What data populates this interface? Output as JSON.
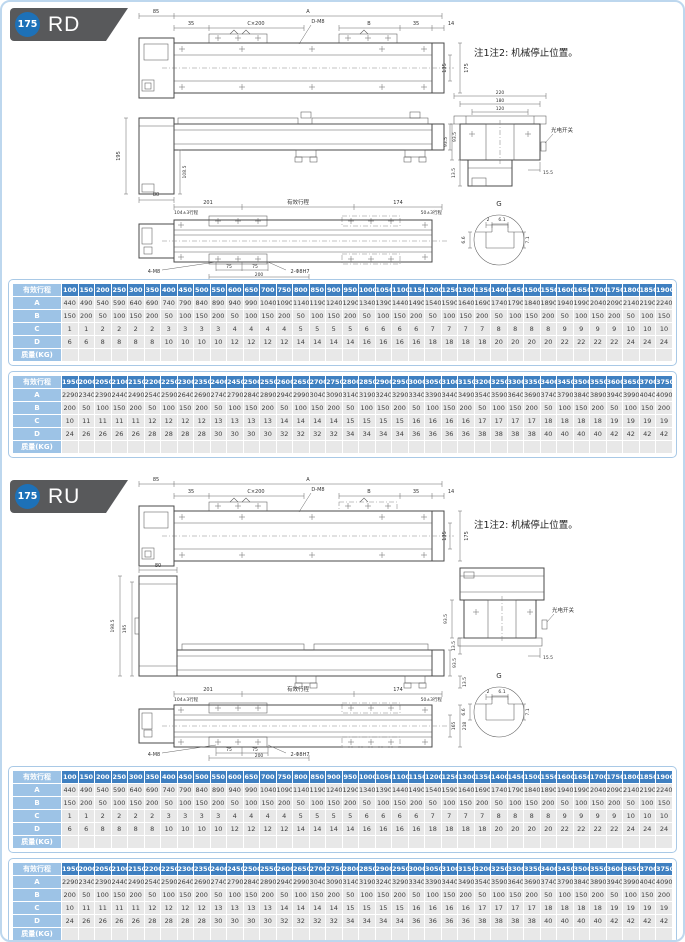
{
  "sections": [
    {
      "title": "RD",
      "badge": "175",
      "note": "注1注2: 机械停止位置。",
      "dims": {
        "a": "A",
        "b": "B",
        "d85": "85",
        "d35": "35",
        "c200": "C×200",
        "dm8": "D-M8",
        "d14": "14",
        "d135": "135",
        "d175": "175",
        "d195": "195",
        "d1085": "108.5",
        "d80": "80",
        "d935": "93.5",
        "d135s": "13.5",
        "d155": "15.5",
        "d201": "201",
        "stroke": "有效行程",
        "d174": "174",
        "d104": "104±3行程",
        "d50": "50±3行程",
        "d75": "75",
        "d200": "200",
        "m4": "4-M8",
        "m2": "2-Φ8H7",
        "d220": "220",
        "d180": "180",
        "d120": "120",
        "sw": "光电开关",
        "g": "G",
        "g2": "2",
        "g61": "6.1",
        "g71": "7.1",
        "g66": "6.6"
      }
    },
    {
      "title": "RU",
      "badge": "175",
      "note": "注1注2: 机械停止位置。",
      "dims": {
        "a": "A",
        "b": "B",
        "d85": "85",
        "d35": "35",
        "c200": "C×200",
        "dm8": "D-M8",
        "d14": "14",
        "d135": "135",
        "d175": "175",
        "d195": "195",
        "d1985": "198.5",
        "d80": "80",
        "d935": "93.5",
        "d135s": "13.5",
        "d155": "15.5",
        "d201": "201",
        "stroke": "有效行程",
        "d174": "174",
        "d104": "104±3行程",
        "d50": "50±3行程",
        "d75": "75",
        "d200": "200",
        "m4": "4-M8",
        "m2": "2-Φ8H7",
        "d165": "165",
        "d218": "218",
        "sw": "光电开关",
        "g": "G",
        "g2": "2",
        "g61": "6.1",
        "g71": "7.1",
        "g66": "6.6"
      }
    }
  ],
  "tables": [
    {
      "header_label": "有效行程",
      "strokes": [
        100,
        150,
        200,
        250,
        300,
        350,
        400,
        450,
        500,
        550,
        600,
        650,
        700,
        750,
        800,
        850,
        900,
        950,
        1000,
        1050,
        1100,
        1150,
        1200,
        1250,
        1300,
        1350,
        1400,
        1450,
        1500,
        1550,
        1600,
        1650,
        1700,
        1750,
        1800,
        1850,
        1900
      ],
      "rows": [
        {
          "label": "A",
          "values": [
            440,
            490,
            540,
            590,
            640,
            690,
            740,
            790,
            840,
            890,
            940,
            990,
            1040,
            1090,
            1140,
            1190,
            1240,
            1290,
            1340,
            1390,
            1440,
            1490,
            1540,
            1590,
            1640,
            1690,
            1740,
            1790,
            1840,
            1890,
            1940,
            1990,
            2040,
            2090,
            2140,
            2190,
            2240
          ]
        },
        {
          "label": "B",
          "values": [
            150,
            200,
            50,
            100,
            150,
            200,
            50,
            100,
            150,
            200,
            50,
            100,
            150,
            200,
            50,
            100,
            150,
            200,
            50,
            100,
            150,
            200,
            50,
            100,
            150,
            200,
            50,
            100,
            150,
            200,
            50,
            100,
            150,
            200,
            50,
            100,
            150
          ]
        },
        {
          "label": "C",
          "values": [
            1,
            1,
            2,
            2,
            2,
            2,
            3,
            3,
            3,
            3,
            4,
            4,
            4,
            4,
            5,
            5,
            5,
            5,
            6,
            6,
            6,
            6,
            7,
            7,
            7,
            7,
            8,
            8,
            8,
            8,
            9,
            9,
            9,
            9,
            10,
            10,
            10
          ]
        },
        {
          "label": "D",
          "values": [
            6,
            6,
            8,
            8,
            8,
            8,
            10,
            10,
            10,
            10,
            12,
            12,
            12,
            12,
            14,
            14,
            14,
            14,
            16,
            16,
            16,
            16,
            18,
            18,
            18,
            18,
            20,
            20,
            20,
            20,
            22,
            22,
            22,
            22,
            24,
            24,
            24
          ]
        },
        {
          "label": "质量(KG)",
          "values": []
        }
      ]
    },
    {
      "header_label": "有效行程",
      "strokes": [
        1950,
        2000,
        2050,
        2100,
        2150,
        2200,
        2250,
        2300,
        2350,
        2400,
        2450,
        2500,
        2550,
        2600,
        2650,
        2700,
        2750,
        2800,
        2850,
        2900,
        2950,
        3000,
        3050,
        3100,
        3150,
        3200,
        3250,
        3300,
        3350,
        3400,
        3450,
        3500,
        3550,
        3600,
        3650,
        3700,
        3750
      ],
      "rows": [
        {
          "label": "A",
          "values": [
            2290,
            2340,
            2390,
            2440,
            2490,
            2540,
            2590,
            2640,
            2690,
            2740,
            2790,
            2840,
            2890,
            2940,
            2990,
            3040,
            3090,
            3140,
            3190,
            3240,
            3290,
            3340,
            3390,
            3440,
            3490,
            3540,
            3590,
            3640,
            3690,
            3740,
            3790,
            3840,
            3890,
            3940,
            3990,
            4040,
            4090
          ]
        },
        {
          "label": "B",
          "values": [
            200,
            50,
            100,
            150,
            200,
            50,
            100,
            150,
            200,
            50,
            100,
            150,
            200,
            50,
            100,
            150,
            200,
            50,
            100,
            150,
            200,
            50,
            100,
            150,
            200,
            50,
            100,
            150,
            200,
            50,
            100,
            150,
            200,
            50,
            100,
            150,
            200
          ]
        },
        {
          "label": "C",
          "values": [
            10,
            11,
            11,
            11,
            11,
            12,
            12,
            12,
            12,
            13,
            13,
            13,
            13,
            14,
            14,
            14,
            14,
            15,
            15,
            15,
            15,
            16,
            16,
            16,
            16,
            17,
            17,
            17,
            17,
            18,
            18,
            18,
            18,
            19,
            19,
            19,
            19
          ]
        },
        {
          "label": "D",
          "values": [
            24,
            26,
            26,
            26,
            26,
            28,
            28,
            28,
            28,
            30,
            30,
            30,
            30,
            32,
            32,
            32,
            32,
            34,
            34,
            34,
            34,
            36,
            36,
            36,
            36,
            38,
            38,
            38,
            38,
            40,
            40,
            40,
            40,
            42,
            42,
            42,
            42
          ]
        },
        {
          "label": "质量(KG)",
          "values": []
        }
      ]
    }
  ]
}
